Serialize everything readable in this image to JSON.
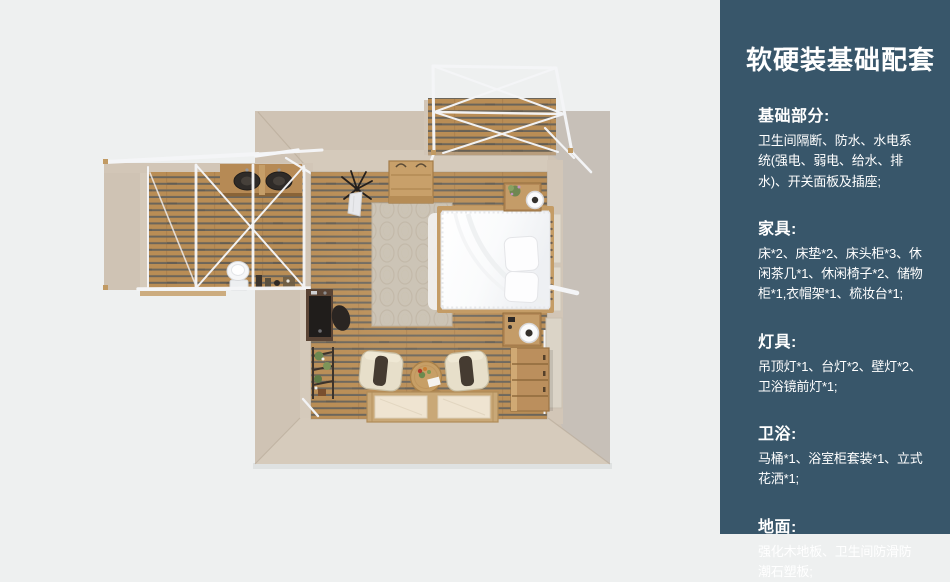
{
  "page": {
    "background": "#eef0f0"
  },
  "sidebar": {
    "background": "#38566a",
    "text_color": "#ffffff",
    "title": "软硬装基础配套",
    "sections": [
      {
        "heading": "基础部分:",
        "body": "卫生间隔断、防水、水电系统(强电、弱电、给水、排水)、开关面板及插座;"
      },
      {
        "heading": "家具:",
        "body": "床*2、床垫*2、床头柜*3、休闲茶几*1、休闲椅子*2、储物柜*1,衣帽架*1、梳妆台*1;"
      },
      {
        "heading": "灯具:",
        "body": "吊顶灯*1、台灯*2、壁灯*2、卫浴镜前灯*1;"
      },
      {
        "heading": "卫浴:",
        "body": "马桶*1、浴室柜套装*1、立式花洒*1;"
      },
      {
        "heading": "地面:",
        "body": "强化木地板、卫生间防滑防潮石塑板;"
      }
    ]
  },
  "floorplan": {
    "view": "top-down-3d-render",
    "colors": {
      "wall": "#cfc3b4",
      "wall_inner": "#d5cabb",
      "wall_gray": "#c7c0b8",
      "floor_wood": "#b98d55",
      "floor_gap": "#6b655a",
      "frame_white": "#f5f6f8"
    },
    "areas": [
      "bedroom",
      "bathroom-with-glass-partition",
      "top-deck-with-canopy"
    ],
    "items": [
      "double-bed",
      "pillows",
      "rug",
      "nightstand-top",
      "nightstand-bottom",
      "table-lamp-top",
      "table-lamp-bottom",
      "storage-chest",
      "lounge-chair-left",
      "lounge-chair-right",
      "tea-table",
      "floor-mats-platform",
      "writing-desk",
      "desk-chair",
      "plant-ladder-shelf",
      "coat-rack",
      "wood-crate",
      "twin-basin-vanity",
      "toilet",
      "glass-partition-frame",
      "canopy-frame",
      "wall-panels",
      "towel-bar"
    ]
  }
}
